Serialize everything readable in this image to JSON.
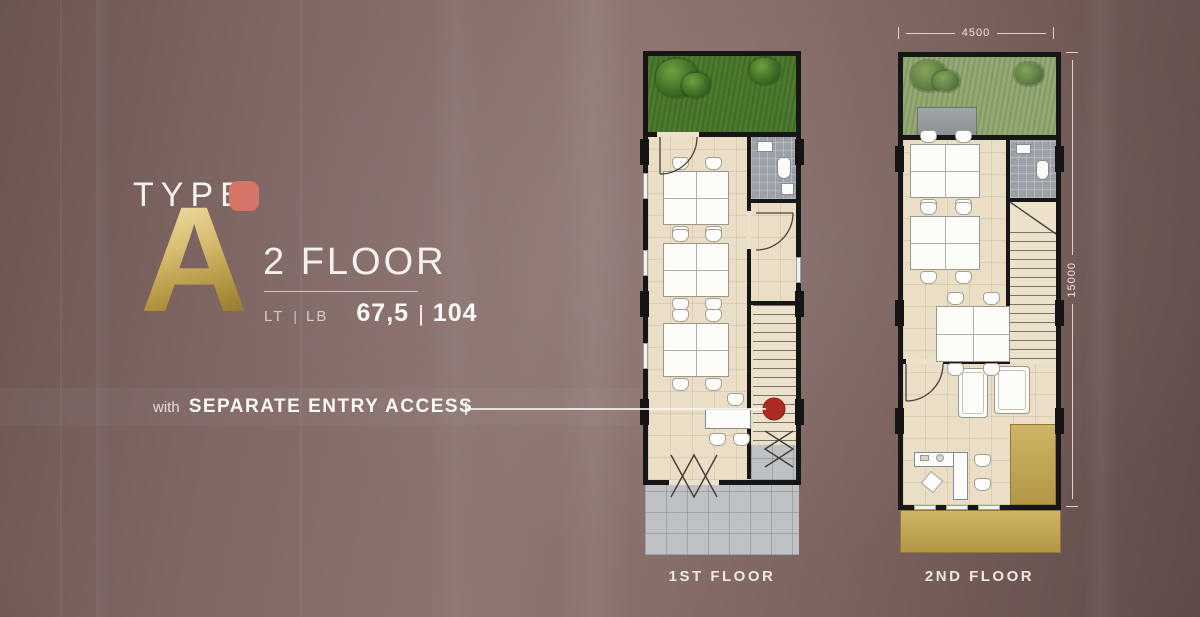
{
  "title": {
    "type_label": "TYPE",
    "type_letter": "A",
    "floors": "2 FLOOR",
    "lt_label": "LT",
    "lb_label": "LB",
    "sep": "|",
    "lt_value": "67,5",
    "lb_value": "104"
  },
  "callout": {
    "prefix": "with",
    "text": "SEPARATE ENTRY ACCESS"
  },
  "plans": [
    {
      "label": "1ST FLOOR",
      "features": [
        "front garden",
        "office desk clusters",
        "bathroom",
        "staircase",
        "meeting table",
        "entry terrace paving",
        "entry marker dot"
      ]
    },
    {
      "label": "2ND FLOOR",
      "dimensions": {
        "width_mm": "4500",
        "height_mm": "15000"
      },
      "features": [
        "roof garden",
        "roof deck",
        "office desk clusters",
        "bathroom",
        "staircase",
        "lounge sofas",
        "executive desk",
        "balcony"
      ]
    }
  ],
  "colors": {
    "background_base": "#7f6764",
    "background_dark": "#5d4946",
    "accent_salmon": "#d5756a",
    "gold_letter": "#c9ad62",
    "text_white": "#f6f1ee",
    "wall_black": "#161616",
    "floor_beige": "#eadec6",
    "garden_first_floor": "#4d7a2f",
    "garden_roof": "#93aa73",
    "paving_grey": "#bfc2c4",
    "bathroom_grey": "#9ba1a6",
    "balcony_gold": "#c7a84e",
    "entry_marker_red": "#ad2a22",
    "desk_white": "#fcfcf9"
  }
}
